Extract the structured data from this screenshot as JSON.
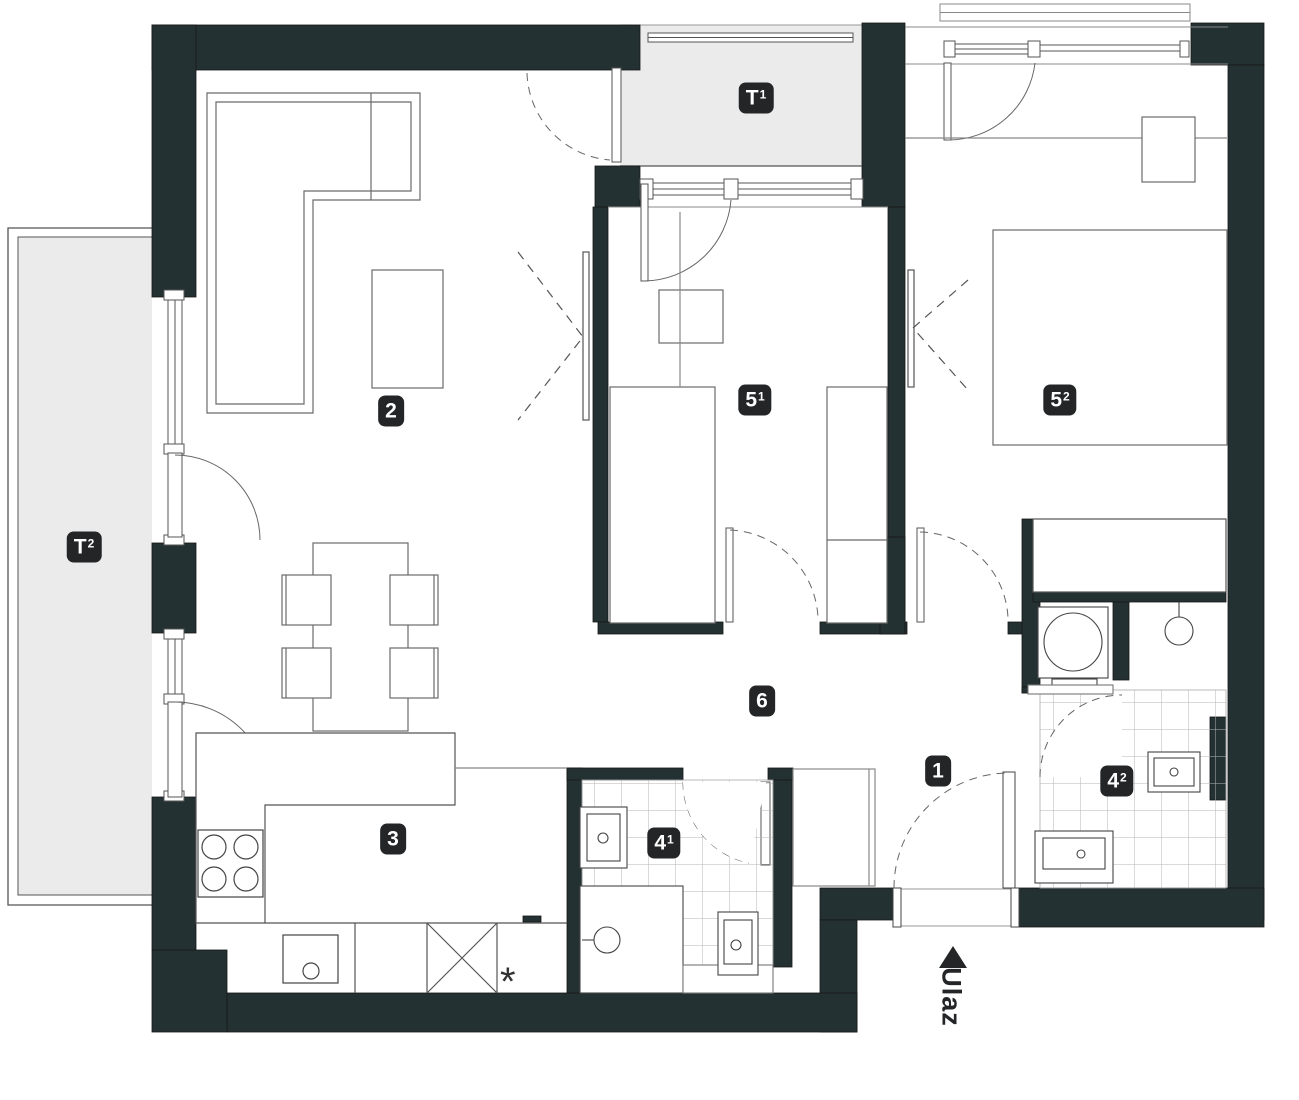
{
  "plan": {
    "type": "apartment-floor-plan",
    "entrance_label": "Ulaz",
    "rooms": [
      {
        "id": "terrace-t1",
        "label": "T",
        "sup": "1"
      },
      {
        "id": "terrace-t2",
        "label": "T",
        "sup": "2"
      },
      {
        "id": "room-2-living",
        "label": "2",
        "sup": ""
      },
      {
        "id": "room-3-kitchen",
        "label": "3",
        "sup": ""
      },
      {
        "id": "room-4-1-bathroom",
        "label": "4",
        "sup": "1"
      },
      {
        "id": "room-4-2-bathroom",
        "label": "4",
        "sup": "2"
      },
      {
        "id": "room-5-1-bedroom",
        "label": "5",
        "sup": "1"
      },
      {
        "id": "room-5-2-bedroom",
        "label": "5",
        "sup": "2"
      },
      {
        "id": "room-6-hall",
        "label": "6",
        "sup": ""
      },
      {
        "id": "room-1-entry",
        "label": "1",
        "sup": ""
      }
    ],
    "symbols": {
      "kitchen_appliance_mark": "*",
      "entrance_arrow": "up-triangle"
    },
    "colors": {
      "wall": "#243133",
      "outer_edge": "#161616",
      "terrace_fill": "#ebebeb",
      "badge": "#232527",
      "badge_text": "#ffffff",
      "furniture_line": "#6a6a6a",
      "fixture_line": "#444444",
      "tile_line": "#b5b5b5"
    }
  }
}
